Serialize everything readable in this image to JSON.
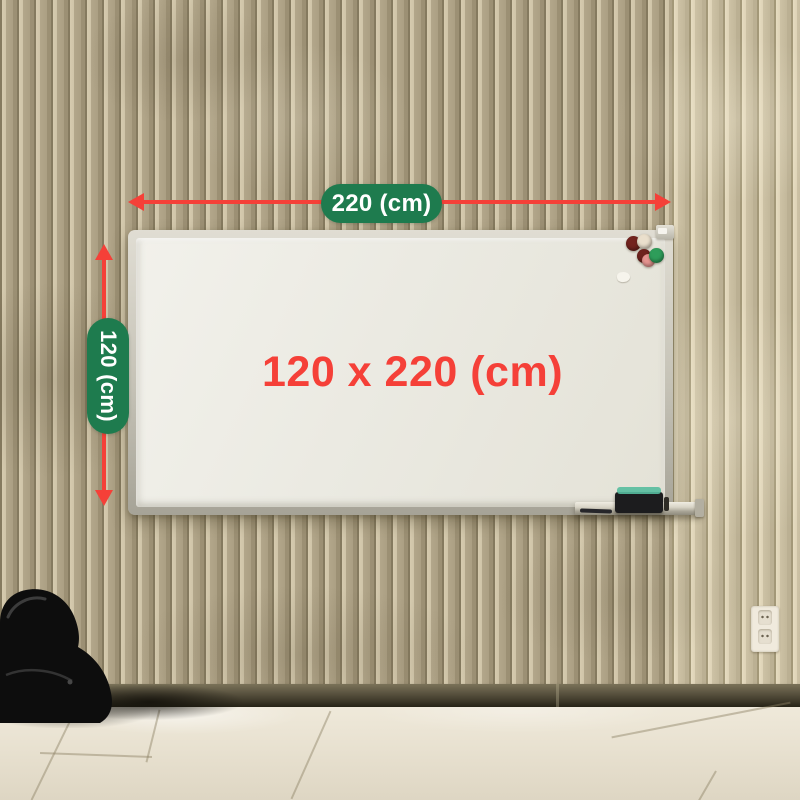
{
  "annotations": {
    "width_pill": "220 (cm)",
    "height_pill": "120 (cm)",
    "board_dimensions": "120 x 220 (cm)"
  },
  "colors": {
    "pill_green": "#1E7B4E",
    "arrow_red": "#F54038",
    "dimension_text_red": "#F54038"
  },
  "board": {
    "magnets": [
      "#72231E",
      "#EADFCC",
      "#6E231E",
      "#E59490",
      "#2E9D5A"
    ],
    "eraser_felt": "#57BD9E"
  }
}
